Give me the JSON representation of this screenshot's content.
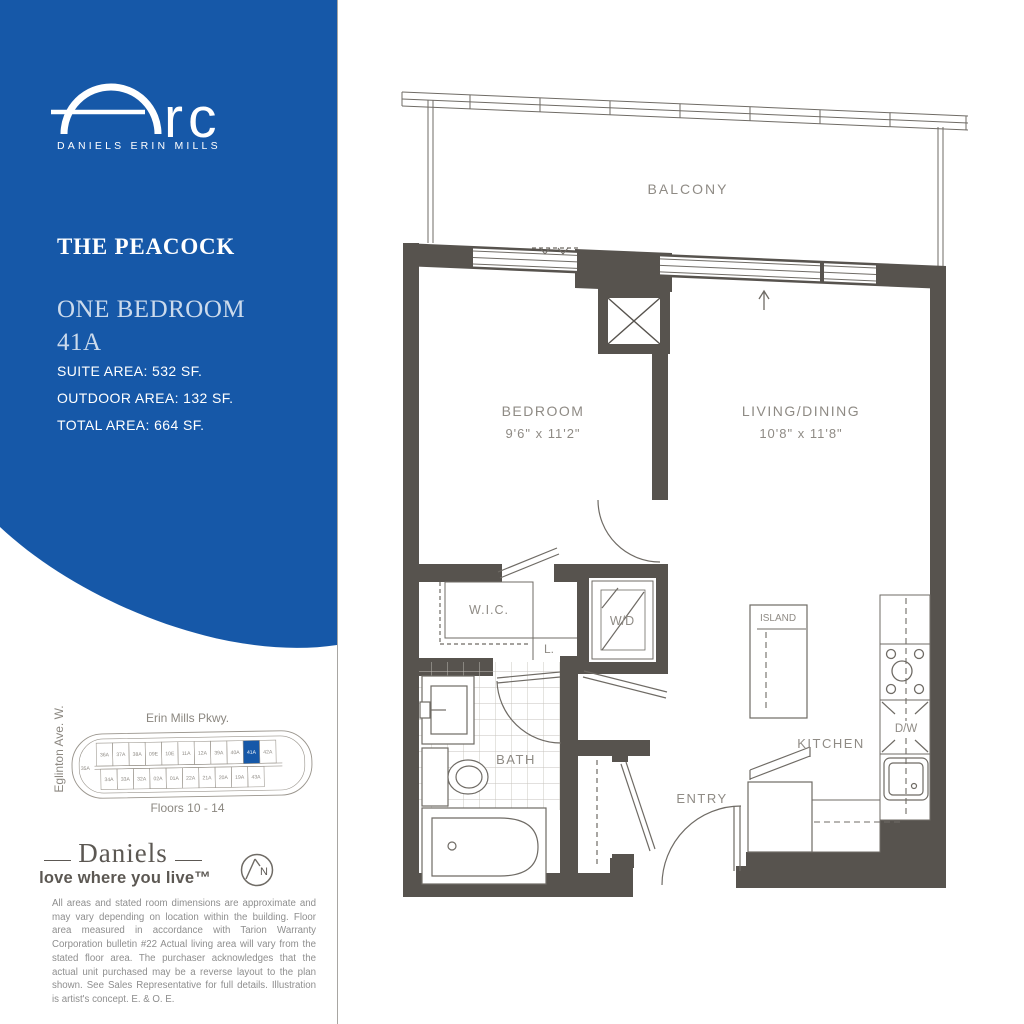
{
  "brand": {
    "logo_word": "rc",
    "tagline": "DANIELS ERIN MILLS"
  },
  "suite": {
    "name": "THE PEACOCK",
    "type": "ONE BEDROOM",
    "unit": "41A",
    "suite_area": "SUITE AREA: 532 SF.",
    "outdoor_area": "OUTDOOR AREA: 132 SF.",
    "total_area": "TOTAL AREA: 664 SF."
  },
  "keyplan": {
    "street_top": "Erin Mills Pkwy.",
    "street_left": "Eglinton Ave. W.",
    "floors_label": "Floors 10 - 14",
    "highlighted_unit": "41A",
    "unit_left": "35A",
    "units_top": [
      "36A",
      "37A",
      "38A",
      "09E",
      "10E",
      "11A",
      "12A",
      "39A",
      "40A",
      "41A",
      "42A"
    ],
    "units_bottom": [
      "34A",
      "33A",
      "32A",
      "02A",
      "01A",
      "22A",
      "21A",
      "20A",
      "19A",
      "43A"
    ]
  },
  "developer": {
    "name": "Daniels",
    "tagline": "love where you live™",
    "north_label": "N"
  },
  "disclaimer": "All areas and stated room dimensions are approximate and may vary depending on location within the building. Floor area measured in accordance with Tarion Warranty Corporation bulletin #22 Actual living area will vary from the stated floor area. The purchaser acknowledges that the actual unit purchased may be a reverse layout to the plan shown. See Sales Representative for full details. Illustration is artist's concept. E. & O. E.",
  "plan": {
    "balcony": "BALCONY",
    "bedroom": "BEDROOM",
    "bedroom_dims": "9'6\" x 11'2\"",
    "living": "LIVING/DINING",
    "living_dims": "10'8\" x 11'8\"",
    "wic": "W.I.C.",
    "linen": "L.",
    "washer_dryer": "W/D",
    "bath": "BATH",
    "island": "ISLAND",
    "kitchen": "KITCHEN",
    "dishwasher": "D/W",
    "entry": "ENTRY"
  },
  "colors": {
    "brand_blue": "#1658A8",
    "wall": "#57534E"
  }
}
